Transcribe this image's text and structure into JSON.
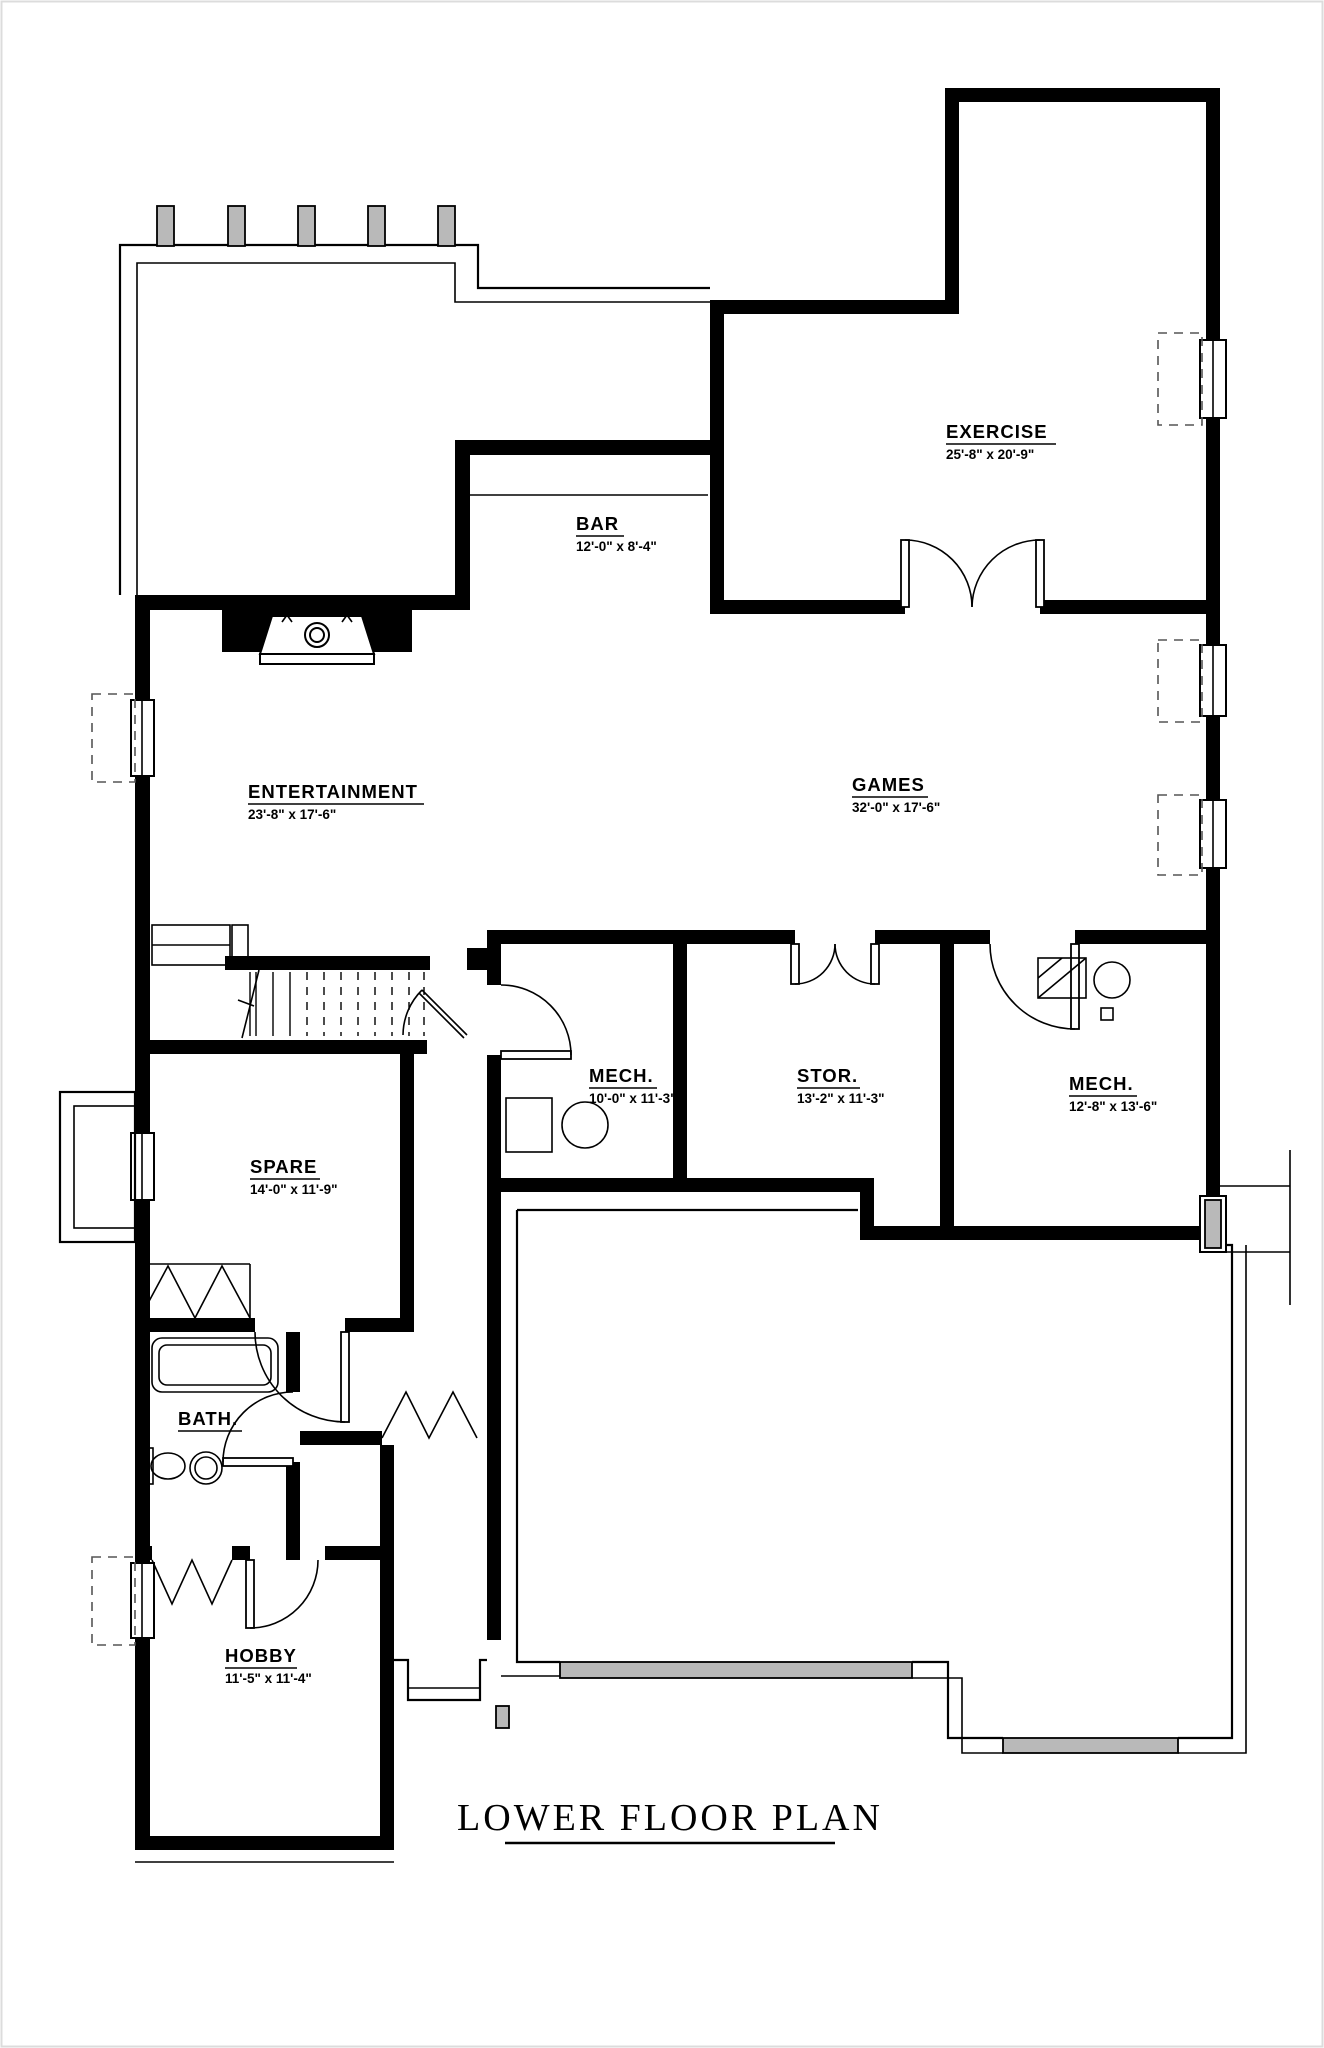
{
  "title": "LOWER FLOOR PLAN",
  "rooms": [
    {
      "name": "EXERCISE",
      "dims": "25'-8\" x 20'-9\""
    },
    {
      "name": "BAR",
      "dims": "12'-0\" x 8'-4\""
    },
    {
      "name": "ENTERTAINMENT",
      "dims": "23'-8\" x 17'-6\""
    },
    {
      "name": "GAMES",
      "dims": "32'-0\" x 17'-6\""
    },
    {
      "name": "MECH.",
      "dims": "10'-0\" x 11'-3\""
    },
    {
      "name": "STOR.",
      "dims": "13'-2\" x 11'-3\""
    },
    {
      "name": "MECH.",
      "dims": "12'-8\" x 13'-6\""
    },
    {
      "name": "SPARE",
      "dims": "14'-0\" x 11'-9\""
    },
    {
      "name": "BATH.",
      "dims": ""
    },
    {
      "name": "HOBBY",
      "dims": "11'-5\" x 11'-4\""
    }
  ],
  "colors": {
    "wall": "#000000",
    "post_fill": "#b9b9b9",
    "patio_fill": "#b9b9b9",
    "dashed_well": "#555555",
    "background": "#ffffff"
  },
  "icons": [
    "fireplace-icon",
    "stairs-icon",
    "tub-icon",
    "toilet-icon",
    "sink-icon",
    "washer-icon",
    "dryer-icon",
    "water-heater-icon",
    "deck-post-icon",
    "window-icon",
    "door-swing-icon",
    "bifold-door-icon",
    "double-door-icon"
  ]
}
